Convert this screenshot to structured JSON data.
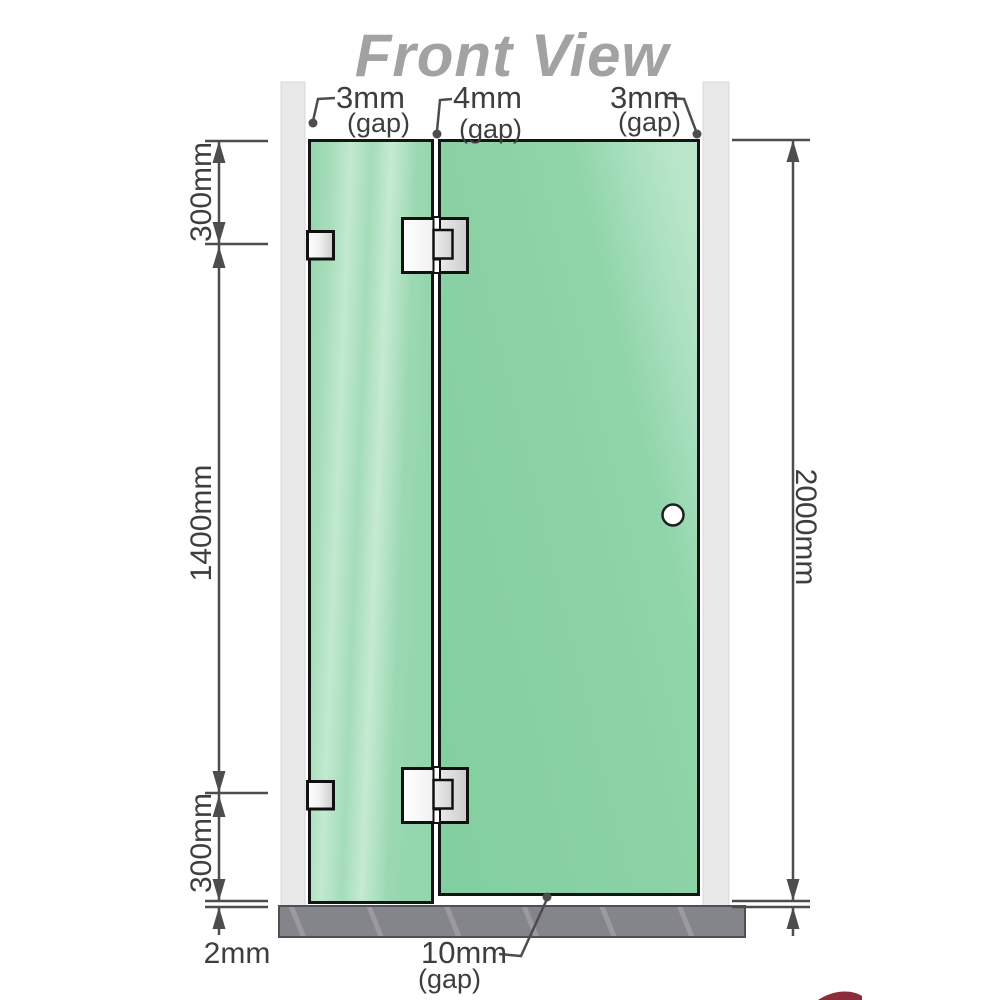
{
  "title": "Front View",
  "top_gaps": [
    {
      "value": "3mm",
      "unit": "(gap)"
    },
    {
      "value": "4mm",
      "unit": "(gap)"
    },
    {
      "value": "3mm",
      "unit": "(gap)"
    }
  ],
  "bottom_gap": {
    "value": "10mm",
    "unit": "(gap)"
  },
  "dimensions": {
    "left_top": "300mm",
    "left_middle": "1400mm",
    "left_bottom": "300mm",
    "floor_clearance": "2mm",
    "total_height": "2000mm"
  },
  "colors": {
    "glass_left": "#9ad7b1",
    "glass_right": "#8ad1a4",
    "wall": "#e9e9e9",
    "floor": "#84848b",
    "dimension_lines": "#4d4d4d",
    "label_text": "#3e3e3e",
    "title_text": "#a2a2a2",
    "hardware": "#e3e3e3",
    "accent_sliver": "#7d1622"
  }
}
